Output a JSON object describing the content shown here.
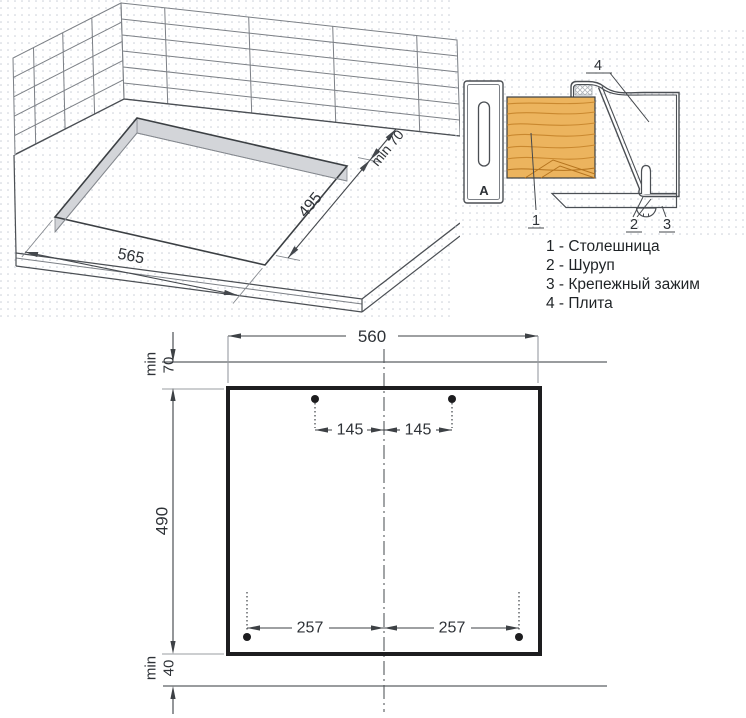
{
  "iso_view": {
    "dim_width": "565",
    "dim_depth": "495",
    "dim_wall_clearance": "min 70"
  },
  "section_view": {
    "callout_1": "1",
    "callout_2": "2",
    "callout_3": "3",
    "callout_4": "4",
    "bracket_letter": "A",
    "legend": [
      "1 - Столешница",
      "2 - Шуруп",
      "3 - Крепежный зажим",
      "4 - Плита"
    ]
  },
  "plan_view": {
    "cutout_width": "560",
    "min_label": "min",
    "top_clearance": "70",
    "cutout_height": "490",
    "bottom_clearance": "40",
    "hole_offset_top": "145",
    "hole_offset_bottom": "257"
  },
  "colors": {
    "wood": "#ecb45e",
    "wood_grain": "#c9882f",
    "cutout_shade": "#d3d5d9",
    "outline_dark": "#1d1d1f",
    "line_gray": "#7c8086",
    "dot_background": "#c9cdd6"
  }
}
